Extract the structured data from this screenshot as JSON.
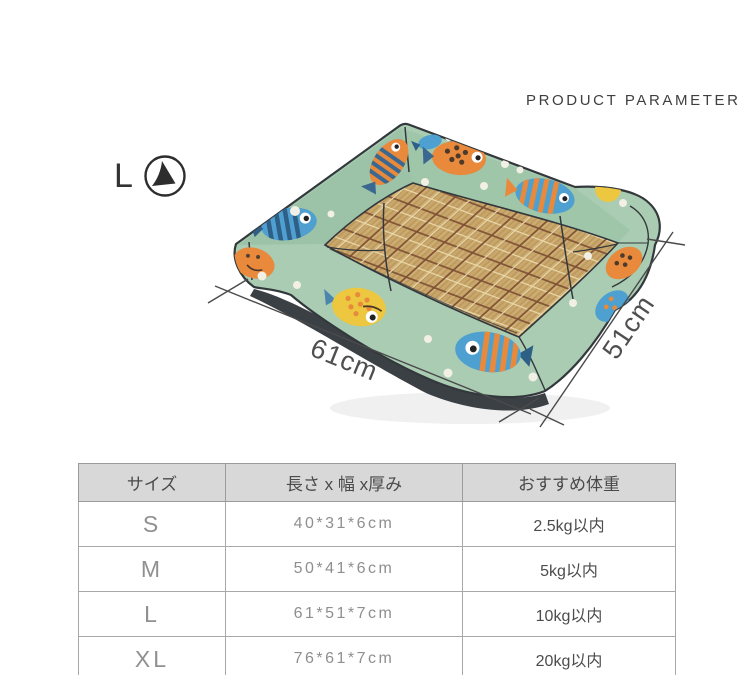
{
  "header": {
    "title": "PRODUCT PARAMETER"
  },
  "badge": {
    "label": "L"
  },
  "illustration": {
    "subject": "pet bed with fish pattern fabric and bamboo mat",
    "length_label": "61cm",
    "depth_label": "51cm"
  },
  "size_table": {
    "headers": [
      "サイズ",
      "長さ x 幅 x厚み",
      "おすすめ体重"
    ],
    "rows": [
      {
        "size": "S",
        "dimensions": "40*31*6cm",
        "weight": "2.5kg以内"
      },
      {
        "size": "M",
        "dimensions": "50*41*6cm",
        "weight": "5kg以内"
      },
      {
        "size": "L",
        "dimensions": "61*51*7cm",
        "weight": "10kg以内"
      },
      {
        "size": "XL",
        "dimensions": "76*61*7cm",
        "weight": "20kg以内"
      }
    ]
  },
  "colors": {
    "fabric_green": "#a9ccb3",
    "fabric_green_shadow": "#9cc3a7",
    "mat_tan": "#c9a76b",
    "plaid_brown": "#7c4f33",
    "plaid_cream": "#ead9ab",
    "accent_orange": "#e8893c",
    "accent_blue": "#4da0cf",
    "accent_navy": "#2e5f87",
    "accent_yellow": "#ecc73f",
    "outline_dark": "#33383c",
    "table_header_bg": "#d8d8d8"
  }
}
